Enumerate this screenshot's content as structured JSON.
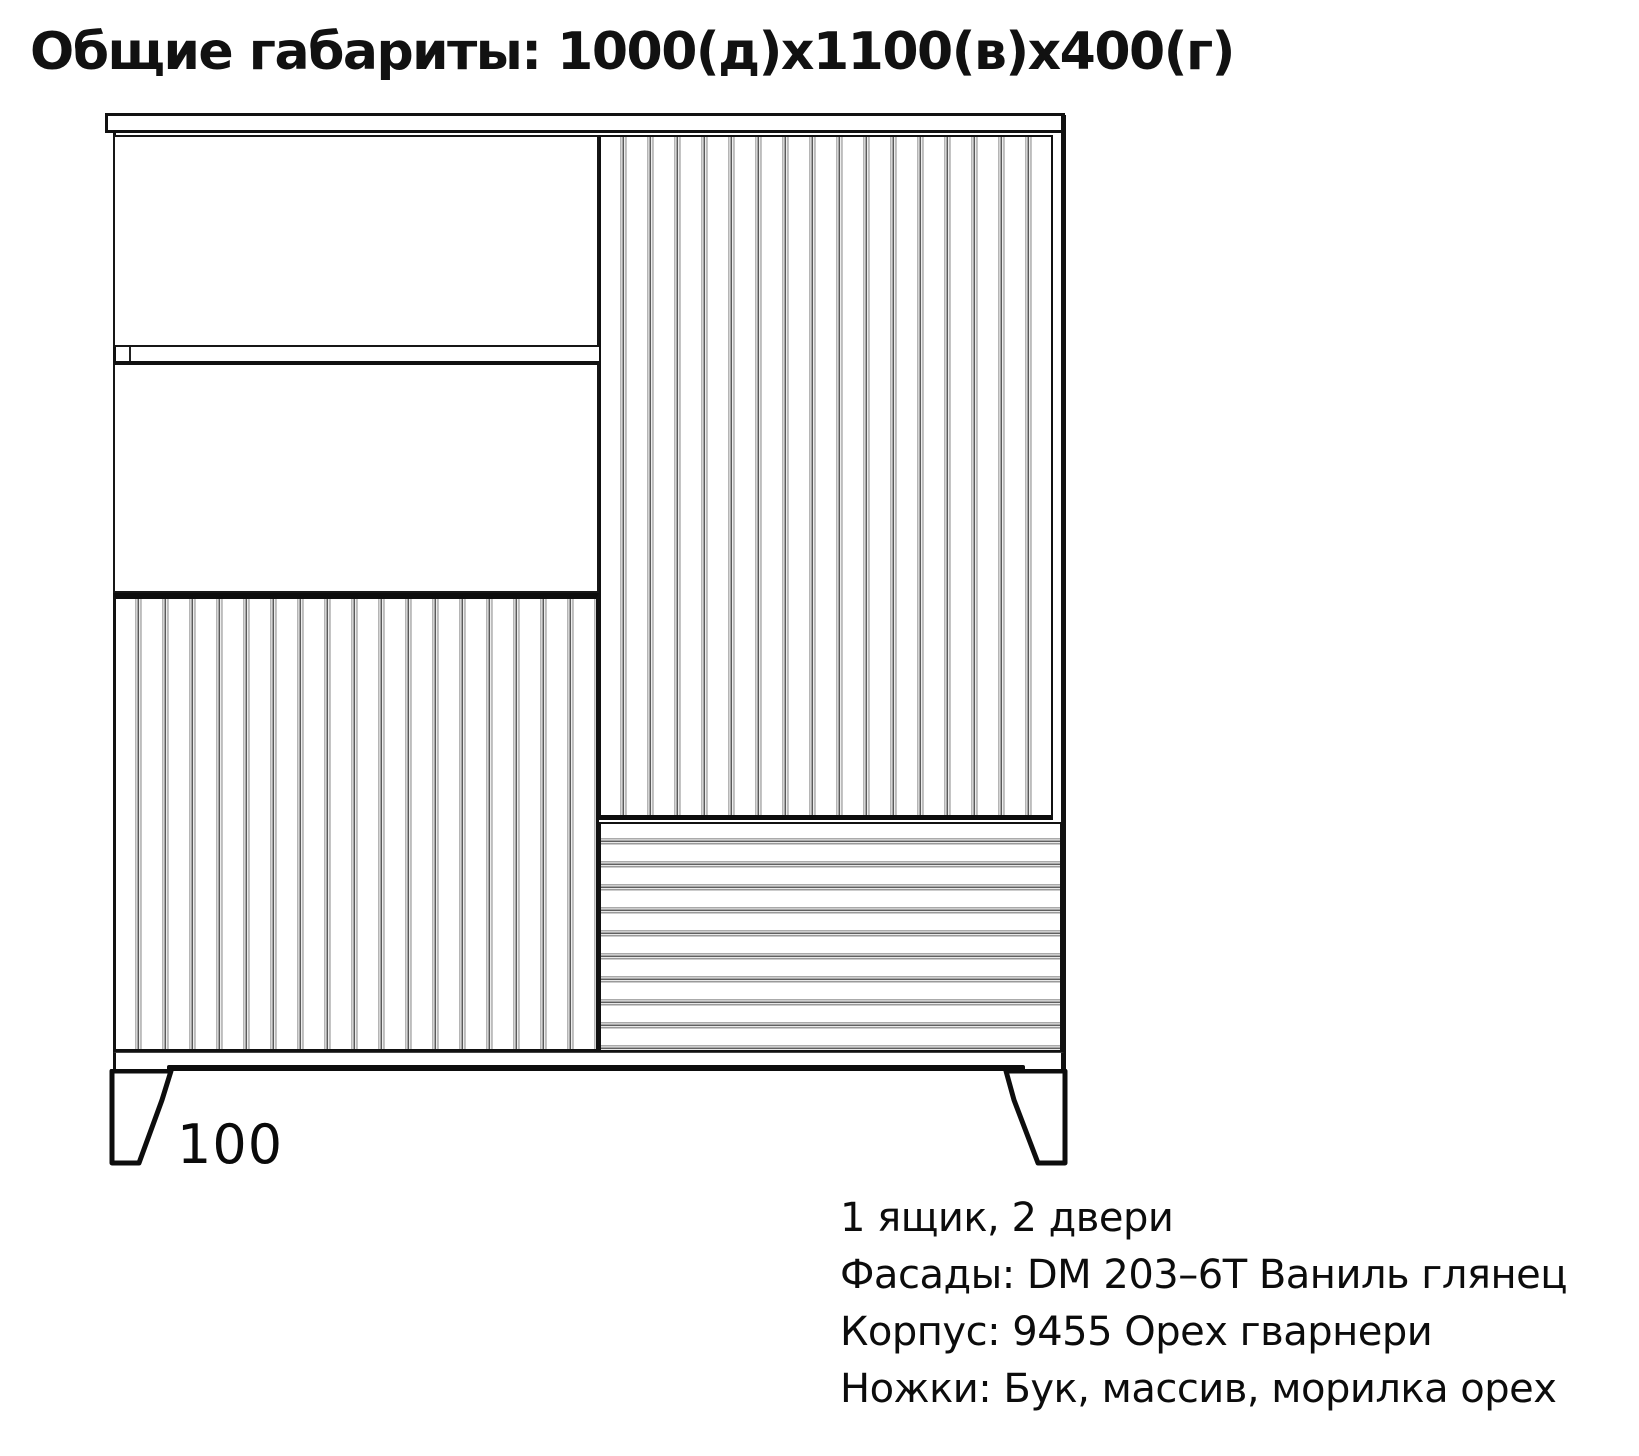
{
  "page": {
    "title": "Общие габариты: 1000(д)х1100(в)х400(г)"
  },
  "drawing": {
    "leg_height_label": "100",
    "colors": {
      "line": "#111111",
      "flute_dark": "#5a5a5a",
      "flute_light": "#b5b5b5",
      "background": "#ffffff"
    }
  },
  "specs": {
    "lines": [
      "1 ящик, 2 двери",
      "Фасады: DM 203–6T Ваниль глянец",
      "Корпус: 9455 Орех гварнери",
      "Ножки: Бук, массив, морилка орех"
    ]
  }
}
